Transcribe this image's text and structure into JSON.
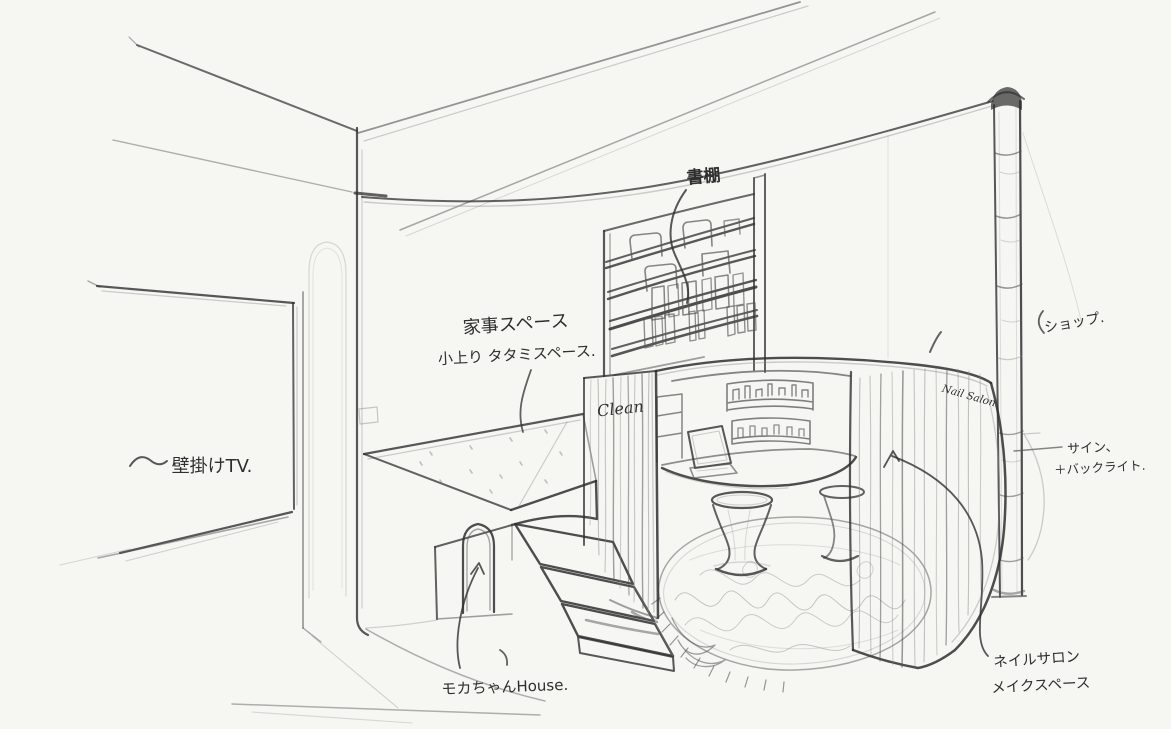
{
  "page": {
    "kind": "hand-drawn interior perspective sketch",
    "paper_color": "#f6f6f3",
    "pencil_dark": "#2f2f2f",
    "pencil_mid": "#555555",
    "pencil_light": "#8a8a8a"
  },
  "annotations": {
    "bookshelf": "書棚",
    "housework_space": "家事スペース",
    "raised_tatami_space": "小上り タタミスペース.",
    "wall_mounted_tv": "壁掛けTV.",
    "wall_mounted_tv_squiggle": "〜",
    "shop": "ショップ.",
    "sign": "サイン、",
    "sign_backlight": "＋バックライト.",
    "nail_salon_jp": "ネイルサロン",
    "makeup_space": "メイクスペース",
    "mocha_chan_house": "モカちゃんHouse.",
    "clean_label": "Clean",
    "nail_salon_label": "Nail Salon"
  }
}
